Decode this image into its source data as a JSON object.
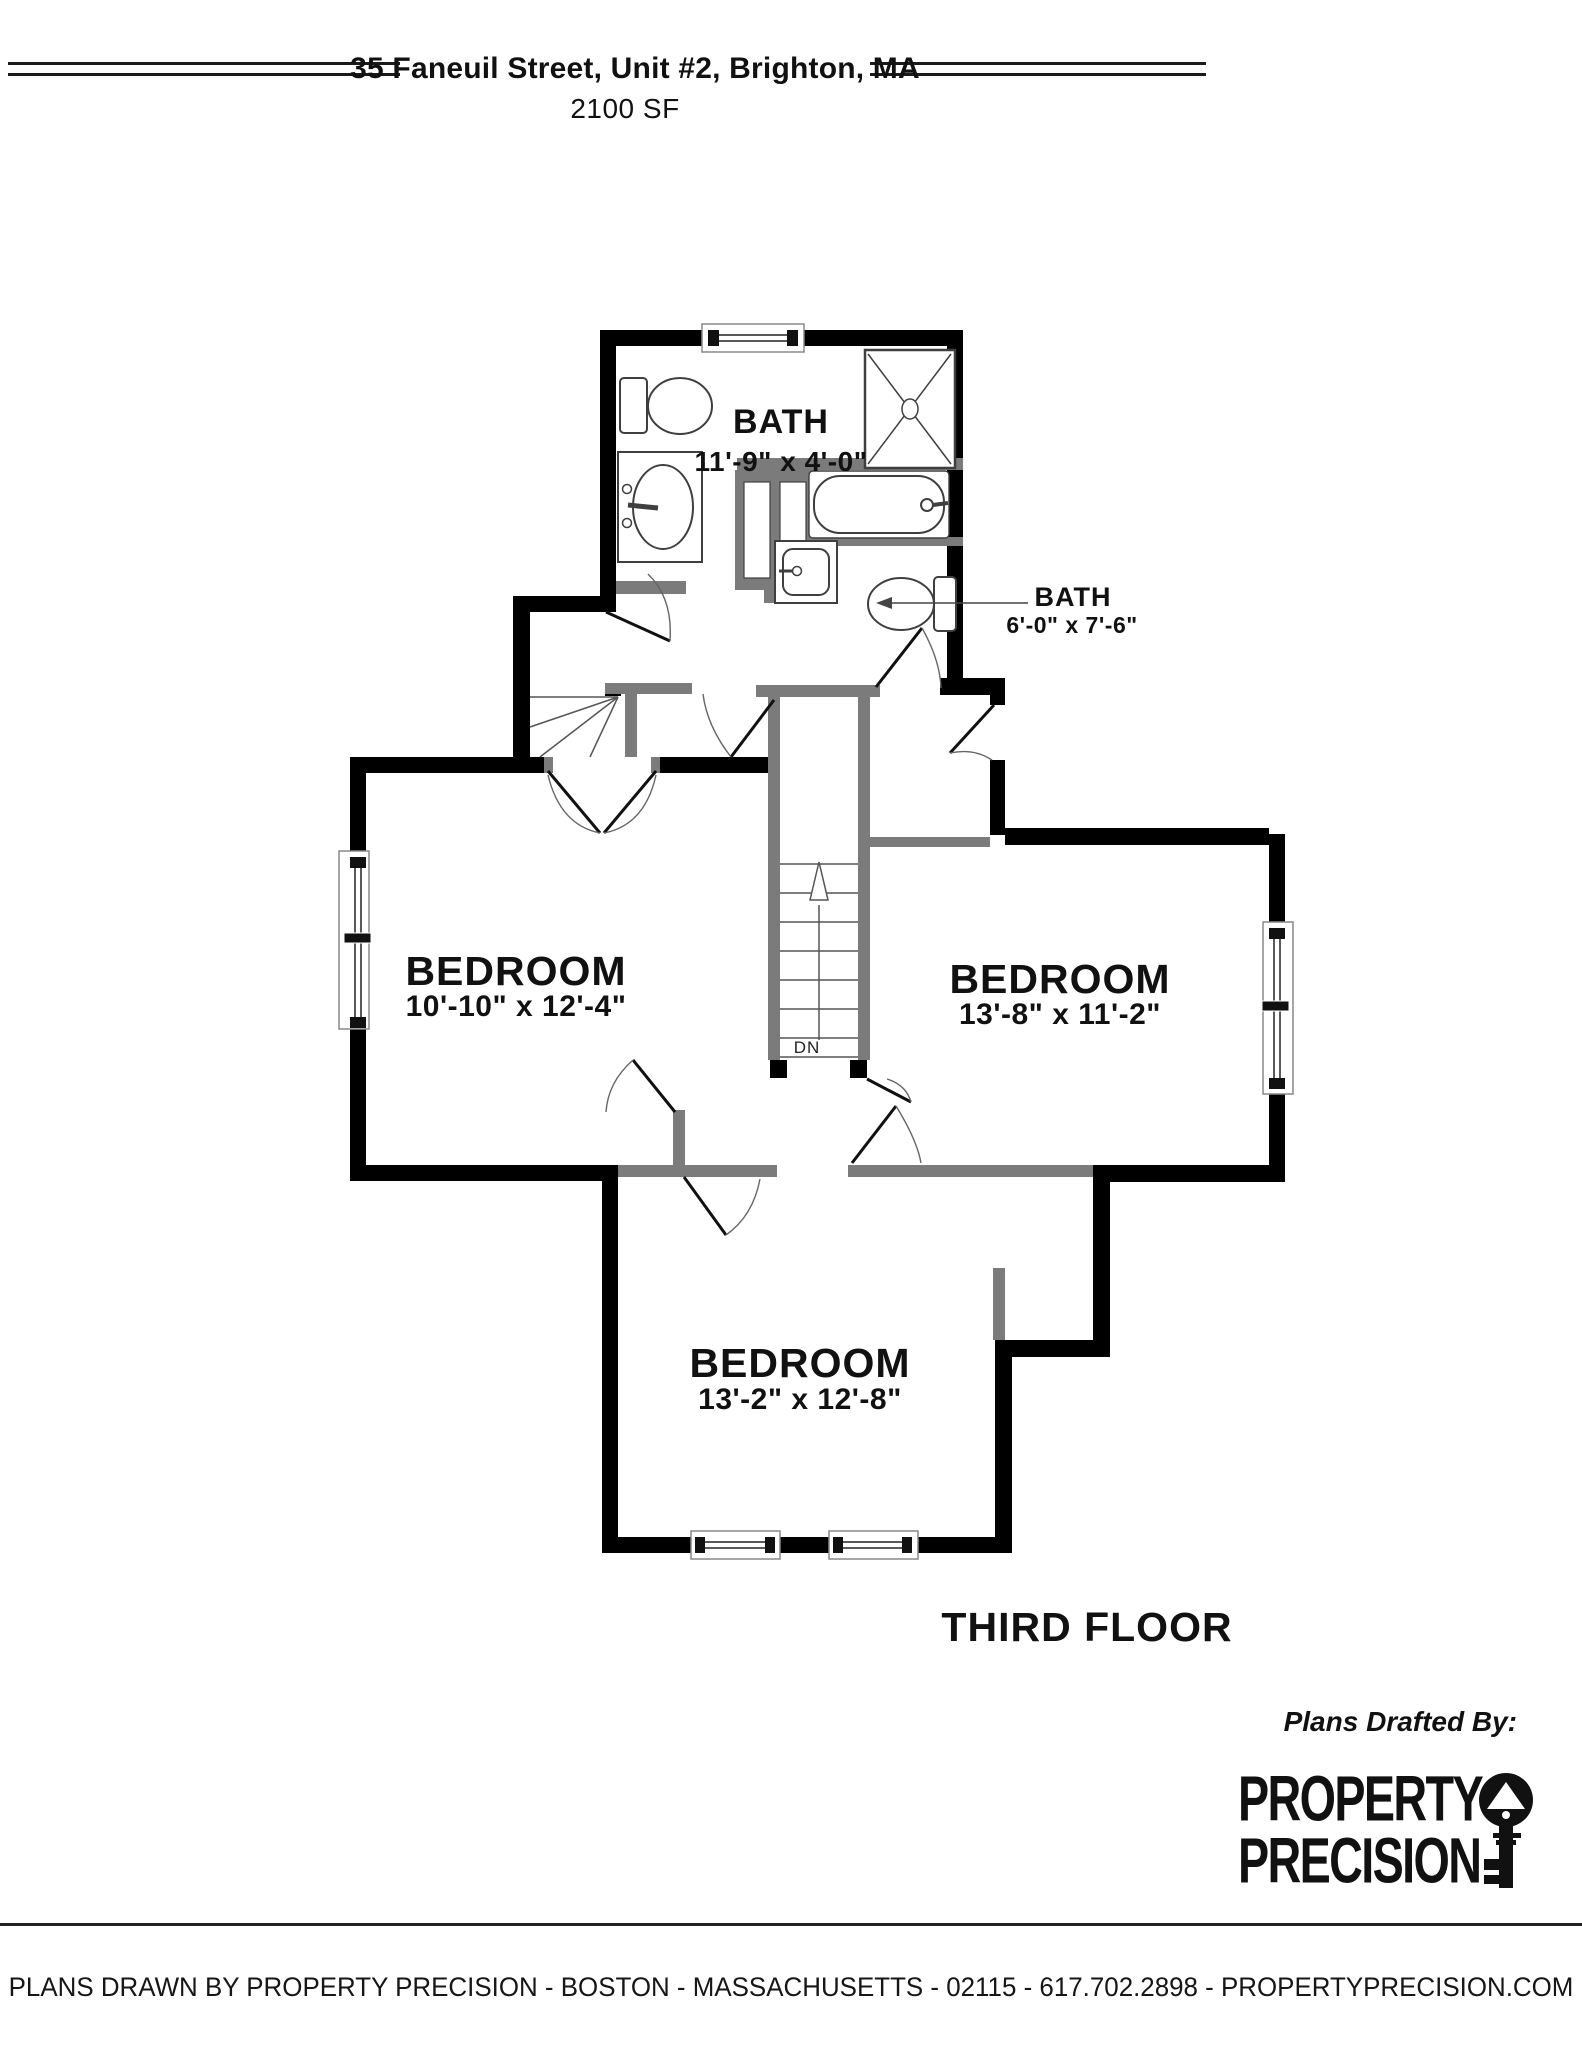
{
  "header": {
    "title": "35 Faneuil Street, Unit #2, Brighton, MA",
    "area": "2100 SF"
  },
  "rooms": [
    {
      "id": "bath-top",
      "name": "BATH",
      "dims": "11'-9\" x 4'-0\""
    },
    {
      "id": "bath-right",
      "name": "BATH",
      "dims": "6'-0\" x 7'-6\""
    },
    {
      "id": "bedroom-left",
      "name": "BEDROOM",
      "dims": "10'-10\" x 12'-4\""
    },
    {
      "id": "bedroom-right",
      "name": "BEDROOM",
      "dims": "13'-8\" x 11'-2\""
    },
    {
      "id": "bedroom-bottom",
      "name": "BEDROOM",
      "dims": "13'-2\" x 12'-8\""
    }
  ],
  "stairs": {
    "down_label": "DN"
  },
  "floor_label": "THIRD FLOOR",
  "credits": {
    "drafted_by": "Plans Drafted By:",
    "logo_line1": "PROPERTY",
    "logo_line2": "PRECISION",
    "logo_icon": "key-icon"
  },
  "footer": {
    "text": "PLANS DRAWN BY PROPERTY PRECISION - BOSTON - MASSACHUSETTS - 02115 - 617.702.2898 - PROPERTYPRECISION.COM"
  },
  "colors": {
    "exterior_wall": "#000000",
    "interior_wall": "#7b7b7b",
    "fixture_outline": "#3f3f3f",
    "background": "#ffffff"
  }
}
